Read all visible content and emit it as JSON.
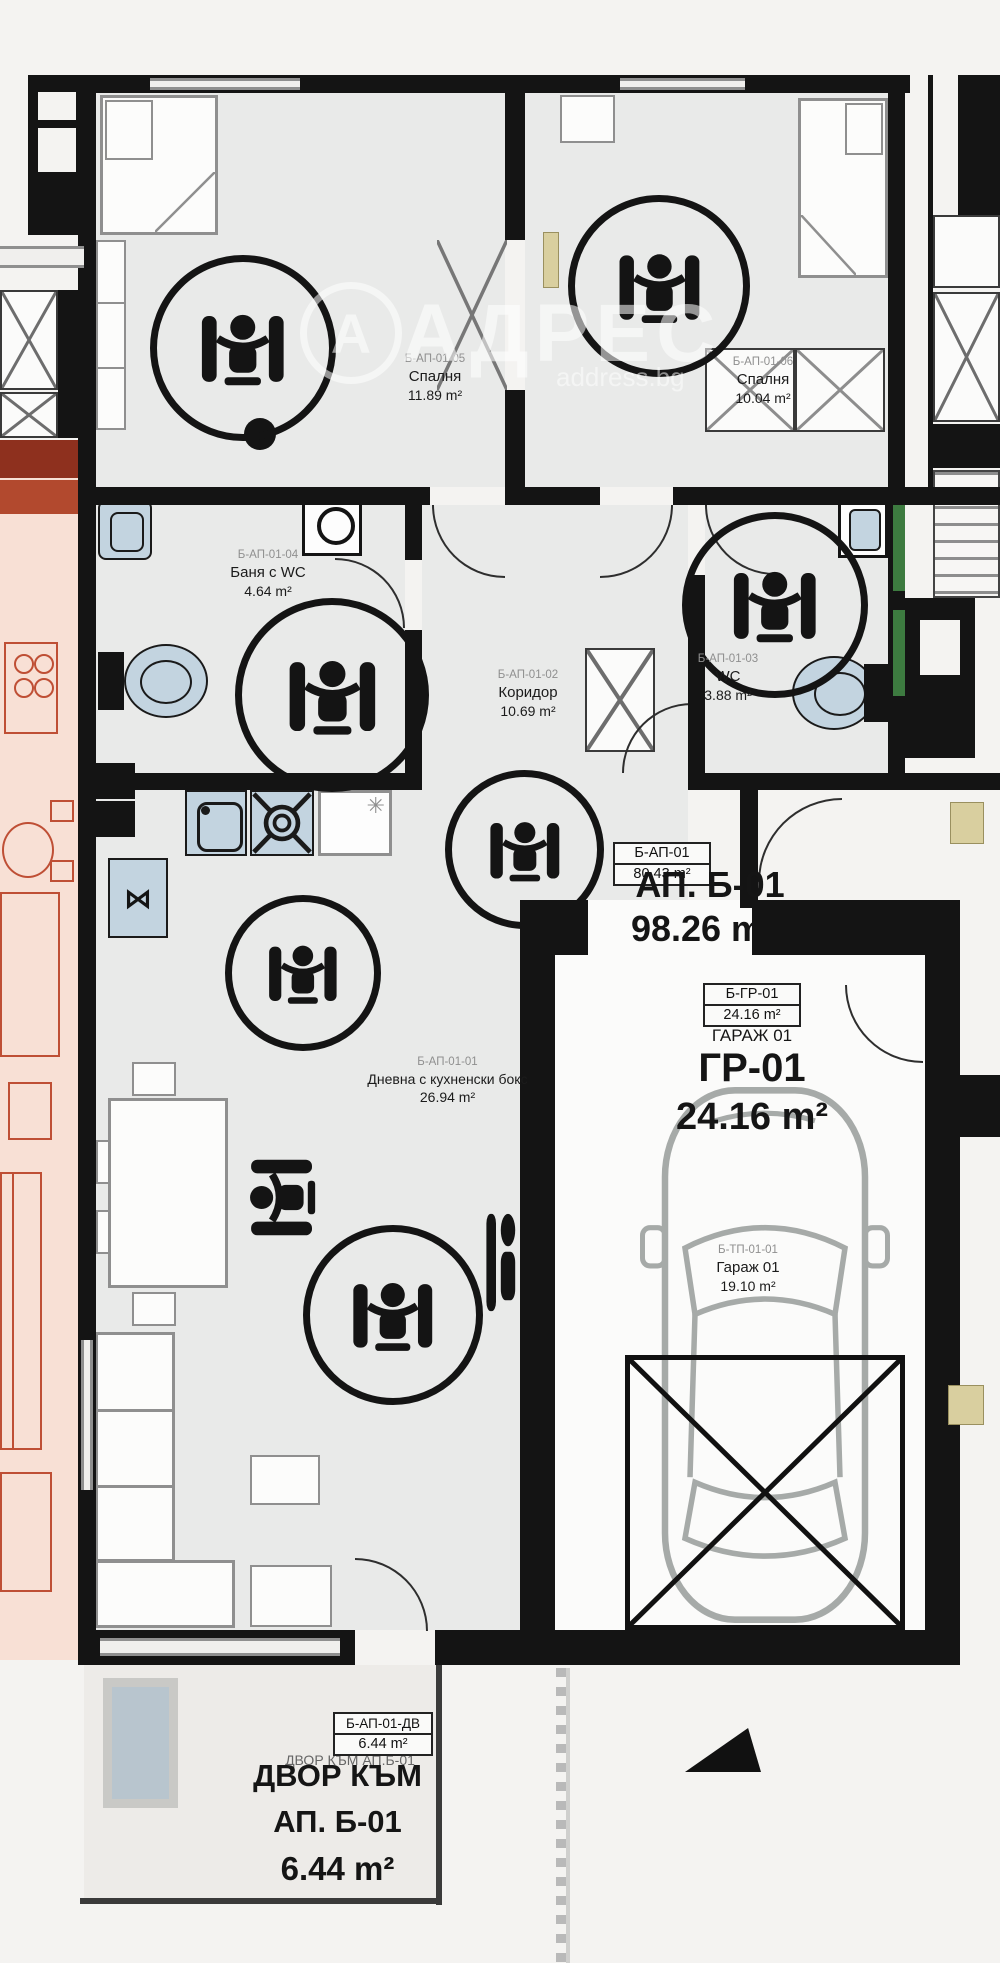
{
  "watermark": {
    "logo_letter": "А",
    "brand": "АДРЕС",
    "site": "address.bg"
  },
  "rooms": {
    "bedroom1": {
      "code": "Б-АП-01-05",
      "name": "Спалня",
      "area": "11.89 m²"
    },
    "bedroom2": {
      "code": "Б-АП-01-06",
      "name": "Спалня",
      "area": "10.04 m²"
    },
    "bathroom": {
      "code": "Б-АП-01-04",
      "name": "Баня с WC",
      "area": "4.64 m²"
    },
    "corridor": {
      "code": "Б-АП-01-02",
      "name": "Коридор",
      "area": "10.69 m²"
    },
    "wc": {
      "code": "Б-АП-01-03",
      "name": "WC",
      "area": "3.88 m²"
    },
    "living": {
      "code": "Б-АП-01-01",
      "name": "Дневна с кухненски бокс",
      "area": "26.94 m²"
    },
    "garage_unit": {
      "code": "Б-ТП-01-01",
      "name": "Гараж 01",
      "area": "19.10 m²"
    }
  },
  "apartment": {
    "box_code": "Б-АП-01",
    "box_area": "80.43 m²",
    "big_title": "АП. Б-01",
    "big_area": "98.26 m²"
  },
  "garage": {
    "box_code": "Б-ГР-01",
    "box_area": "24.16 m²",
    "subtitle": "ГАРАЖ 01",
    "big_title": "ГР-01",
    "big_area": "24.16 m²"
  },
  "yard": {
    "box_code": "Б-АП-01-ДВ",
    "box_area": "6.44 m²",
    "small_label": "ДВОР КЪМ АП.Б-01",
    "big_line1": "ДВОР КЪМ",
    "big_line2": "АП. Б-01",
    "big_line3": "6.44 m²"
  },
  "icons": {
    "dishwasher_glyph": "⋈",
    "freezer_glyph": "✳"
  },
  "colors": {
    "wall": "#141414",
    "fixture_blue": "#c3d4e0",
    "accent_green": "#3d7b40",
    "neighbor_pink": "#f8e0d5",
    "neighbor_red": "#bf4f35",
    "door_tan": "#d9cf9f"
  }
}
